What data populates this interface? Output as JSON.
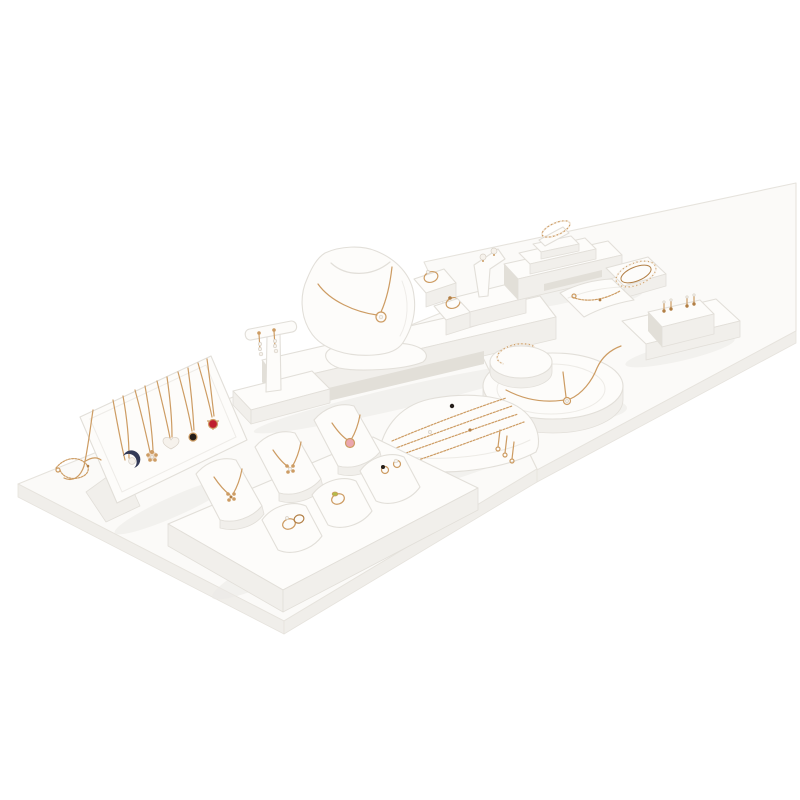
{
  "meta": {
    "description": "White leather jewellery display prop set on two white boards, holding rose-gold necklaces, rings, bracelets, bangles and earrings"
  },
  "palette": {
    "bg": "#ffffff",
    "board": "#fbfaf8",
    "board_side": "#f0eeea",
    "board_edge": "#e6e3dd",
    "item": "#fdfcfa",
    "item_side": "#f1efeb",
    "item_side2": "#e2dfd8",
    "edge": "#e2dfd9",
    "shadow_c": "#eceae5",
    "gold": "#cd9c63",
    "gold_deep": "#b27f45",
    "pearl": "#f6f2ec",
    "pearl_edge": "#d8d1c7",
    "stone_red": "#bf1f2e",
    "stone_black": "#241d19",
    "stone_green": "#b4bc4a",
    "stone_pink": "#eba6ae",
    "stone_navy": "#333a57"
  },
  "items": [
    {
      "id": "display-board-left"
    },
    {
      "id": "display-board-right"
    },
    {
      "id": "necklace-easel"
    },
    {
      "id": "moon-pearl-necklace"
    },
    {
      "id": "flower-necklace"
    },
    {
      "id": "heart-necklace"
    },
    {
      "id": "black-stone-necklace"
    },
    {
      "id": "red-stone-necklace"
    },
    {
      "id": "loose-chain-bracelet"
    },
    {
      "id": "t-bar-earring-stand"
    },
    {
      "id": "necklace-bust"
    },
    {
      "id": "center-bridge-shelf"
    },
    {
      "id": "ring-wedges"
    },
    {
      "id": "stud-earring-flag"
    },
    {
      "id": "pyramid-bangle-stand"
    },
    {
      "id": "crystal-bracelet"
    },
    {
      "id": "chain-bracelet-pillow"
    },
    {
      "id": "drop-earring-ramp"
    },
    {
      "id": "round-collar-display"
    },
    {
      "id": "open-cuff-bangle"
    },
    {
      "id": "bracelet-ramp"
    },
    {
      "id": "jewelry-platform"
    },
    {
      "id": "pendant-wedges"
    },
    {
      "id": "ring-pillows"
    }
  ]
}
